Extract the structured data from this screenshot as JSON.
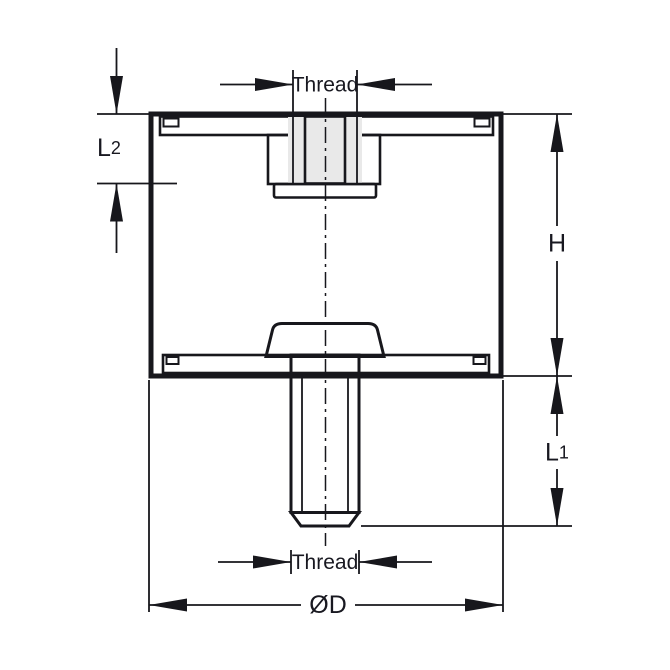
{
  "colors": {
    "background": "#ffffff",
    "line": "#17171c",
    "text": "#181820",
    "rubber_hatch_fill": "#e9e9e9",
    "metal_fill": "#e2e2e2"
  },
  "dimensions": {
    "thread_top": {
      "label": "Thread"
    },
    "depth_l2": {
      "main": "L",
      "sub": "2"
    },
    "height_h": {
      "label": "H"
    },
    "stud_length_l1": {
      "main": "L",
      "sub": "1"
    },
    "thread_bottom": {
      "label": "Thread"
    },
    "outer_diameter": {
      "label": "ØD"
    }
  }
}
